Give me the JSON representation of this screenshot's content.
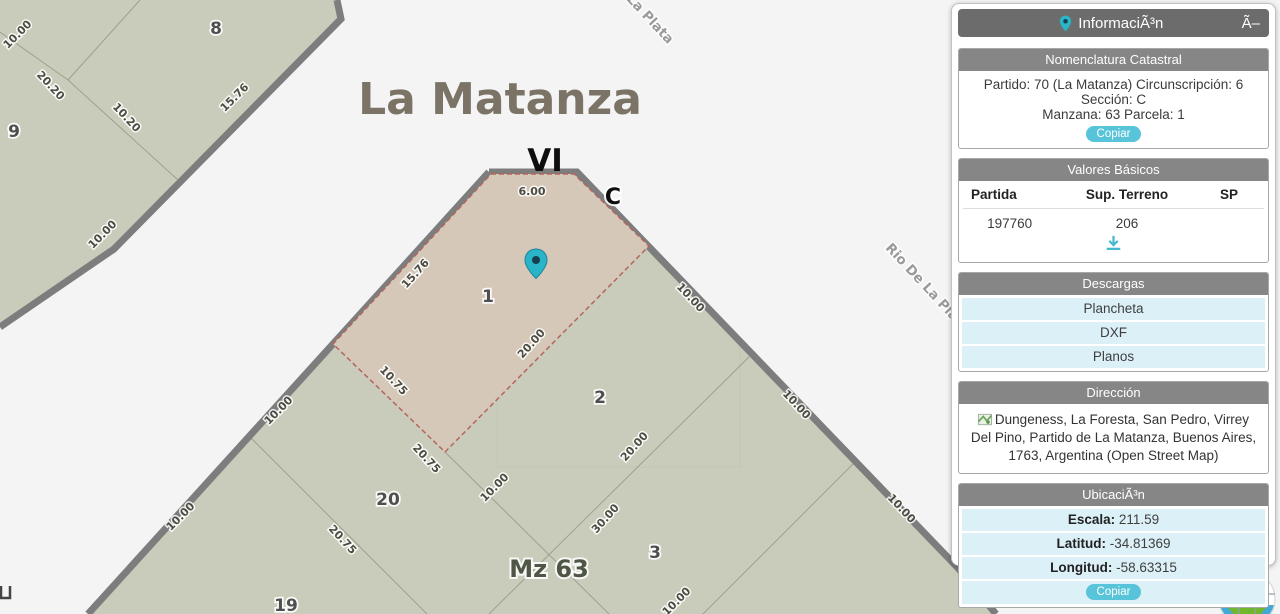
{
  "map": {
    "city_label": "La Matanza",
    "roman_label": "VI",
    "zone_label": "C",
    "block_label": "Mz 63",
    "street_labels": {
      "top": "La Plata",
      "right": "Rio De La Pla",
      "bottom": "La P"
    },
    "parcels": {
      "p1": "1",
      "p2": "2",
      "p3": "3",
      "p8": "8",
      "p9": "9",
      "p19": "19",
      "p20": "20"
    },
    "measurements": [
      "6.00",
      "15.76",
      "20.00",
      "10.75",
      "20.75",
      "20.75",
      "10.00",
      "10.00",
      "10.00",
      "10.00",
      "10.00",
      "30.00",
      "20.00",
      "10.00",
      "10.00",
      "10.00",
      "20.20",
      "10.20",
      "15.76",
      "10.00"
    ],
    "colors": {
      "block_fill": "#c9ccba",
      "selected_parcel_fill": "#d5c8b9",
      "selected_parcel_border": "#b5655c",
      "road_border": "#7d7d7d",
      "street_background": "#f4f4f5",
      "marker": "#2ab4c7"
    }
  },
  "panel": {
    "title": "InformaciÃ³n",
    "close_label": "Ã–",
    "nomenclatura": {
      "header": "Nomenclatura Catastral",
      "line1": "Partido: 70 (La Matanza) Circunscripción: 6 Sección: C",
      "line2": "Manzana: 63 Parcela: 1",
      "copy_label": "Copiar"
    },
    "valores": {
      "header": "Valores Básicos",
      "columns": [
        "Partida",
        "Sup. Terreno",
        "SP"
      ],
      "row": {
        "partida": "197760",
        "sup_terreno": "206",
        "sp": ""
      }
    },
    "descargas": {
      "header": "Descargas",
      "items": [
        "Plancheta",
        "DXF",
        "Planos"
      ]
    },
    "direccion": {
      "header": "Dirección",
      "text": "Dungeness, La Foresta, San Pedro, Virrey Del Pino, Partido de La Matanza, Buenos Aires, 1763, Argentina (Open Street Map)"
    },
    "ubicacion": {
      "header": "UbicaciÃ³n",
      "rows": [
        {
          "label": "Escala:",
          "value": "211.59"
        },
        {
          "label": "Latitud:",
          "value": "-34.81369"
        },
        {
          "label": "Longitud:",
          "value": "-58.63315"
        }
      ],
      "copy_label": "Copiar"
    }
  }
}
